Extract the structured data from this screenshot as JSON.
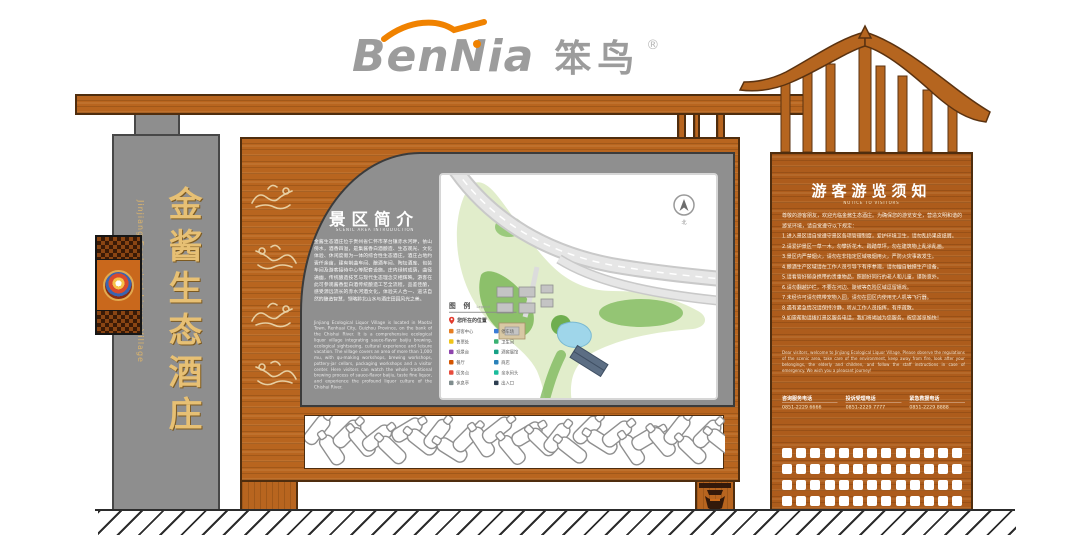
{
  "logo": {
    "latin": "BenNia",
    "cn": "笨鸟",
    "reg": "®"
  },
  "pillar": {
    "cn": "金酱生态酒庄",
    "en": "Jinjiang Ecological Liquor Village"
  },
  "intro": {
    "title": "景区简介",
    "subtitle": "SCENIC AREA INTRODUCTION",
    "cn_text": "金酱生态酒庄位于贵州省仁怀市茅台镇赤水河畔，依山傍水，酒香四溢，是集酱香白酒酿造、生态观光、文化体验、休闲度假为一体的综合性生态酒庄。酒庄占地约壹仟余亩，建有制曲车间、酿酒车间、陶坛酒库、包装车间及游客接待中心等配套设施。庄内绿树成荫，曲径通幽，传统酿造技艺与现代生态理念交相辉映。游客在此可参观酱香型白酒传统酿造工艺全流程，品鉴佳酿，感受源远流长的赤水河酒文化，体验天人合一、道法自然的酿造智慧，领略黔北山水与酒庄田园风光之美。",
    "en_text": "Jinjiang Ecological Liquor Village is located in Maotai Town, Renhuai City, Guizhou Province, on the bank of the Chishui River. It is a comprehensive ecological liquor village integrating sauce-flavor baijiu brewing, ecological sightseeing, cultural experience and leisure vacation. The village covers an area of more than 1,000 mu, with qu-making workshops, brewing workshops, pottery-jar cellars, packaging workshops and a visitor center. Here visitors can watch the whole traditional brewing process of sauce-flavor baijiu, taste fine liquor, and experience the profound liquor culture of the Chishui River."
  },
  "map": {
    "compass": "北",
    "legend": {
      "title": "图 例",
      "subtitle": "Legend",
      "you_are_here": "您所在的位置",
      "items": [
        {
          "label": "游客中心",
          "color": "#e67e22"
        },
        {
          "label": "停车场",
          "color": "#3b7dd8"
        },
        {
          "label": "售票处",
          "color": "#f0c419"
        },
        {
          "label": "卫生间",
          "color": "#3bb273"
        },
        {
          "label": "观景台",
          "color": "#8e44ad"
        },
        {
          "label": "酒窖展馆",
          "color": "#16a085"
        },
        {
          "label": "餐厅",
          "color": "#d35400"
        },
        {
          "label": "商店",
          "color": "#2980b9"
        },
        {
          "label": "医务点",
          "color": "#e74c3c"
        },
        {
          "label": "亲水码头",
          "color": "#1abc9c"
        },
        {
          "label": "休息亭",
          "color": "#7f8c8d"
        },
        {
          "label": "出入口",
          "color": "#2c3e50"
        }
      ]
    }
  },
  "notice": {
    "title": "游客游览须知",
    "subtitle": "NOTICE TO VISITORS",
    "cn_text": "尊敬的游客朋友，欢迎光临金酱生态酒庄。为确保您的游览安全，营造文明和谐的游览环境，请自觉遵守以下规定：\n1.进入景区请自觉遵守景区各项管理制度，爱护环境卫生，请勿乱扔果皮纸屑。\n2.请爱护景区一草一木，勿攀折花木、践踏草坪，勿在建筑物上乱涂乱画。\n3.景区内严禁烟火，请勿在非指定区域吸烟用火，严防火灾事故发生。\n4.酿酒生产区域请在工作人员引导下有序参观，请勿擅自触摸生产设备。\n5.请看管好随身携带的贵重物品，照顾好同行的老人和儿童，谨防意外。\n6.请勿翻越护栏，不要在河边、陡坡等危险区域逗留嬉戏。\n7.未经许可请勿携带宠物入园，请勿在园区内使用无人机等飞行器。\n8.遇有紧急情况请保持冷静，听从工作人员指挥，有序疏散。\n9.如需帮助请拨打景区服务电话，我们将竭诚为您服务。祝您游览愉快！",
    "en_text": "Dear visitors, welcome to Jinjiang Ecological Liquor Village. Please observe the regulations of the scenic area, take care of the environment, keep away from fire, look after your belongings, the elderly and children, and follow the staff instructions in case of emergency. We wish you a pleasant journey!",
    "contacts": [
      {
        "label": "咨询服务电话",
        "number": "0851-2229 6666"
      },
      {
        "label": "投诉受理电话",
        "number": "0851-2229 7777"
      },
      {
        "label": "紧急救援电话",
        "number": "0851-2229 8888"
      }
    ]
  }
}
